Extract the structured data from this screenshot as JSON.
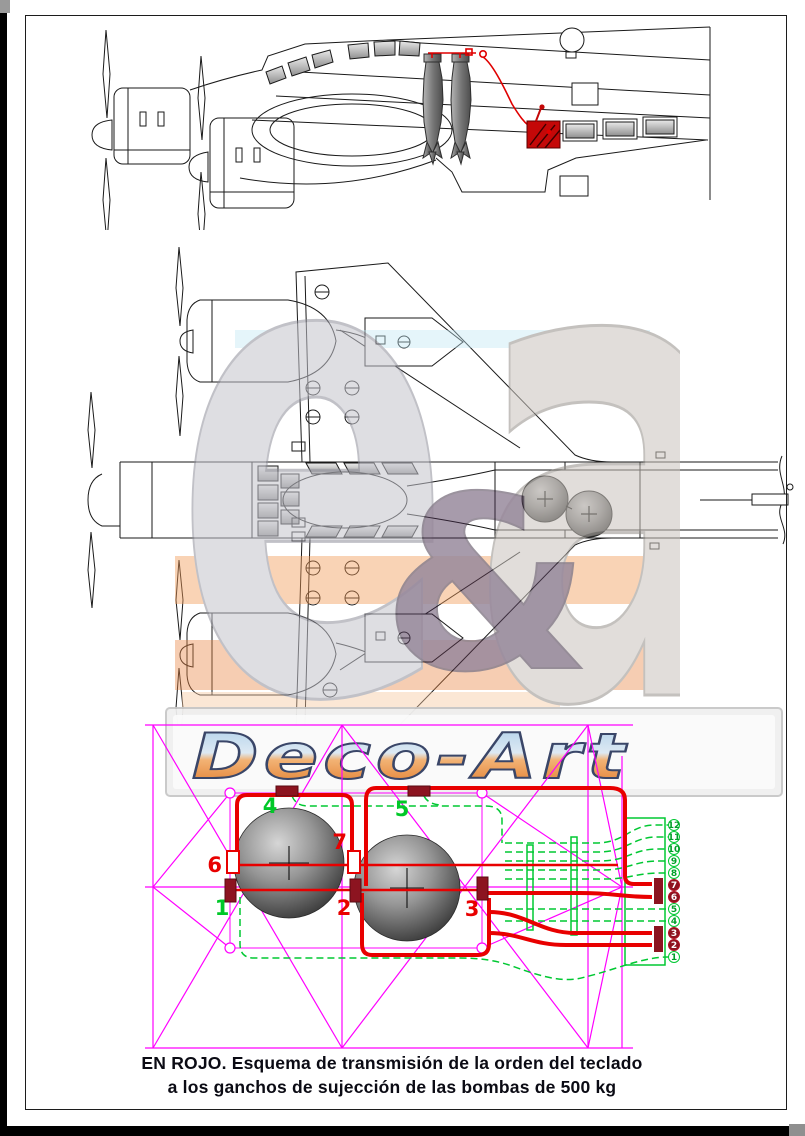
{
  "caption": {
    "line1": "EN ROJO. Esquema de transmisión de la orden del teclado",
    "line2": "a los ganchos de sujección de las bombas de 500 kg"
  },
  "watermark": {
    "logo_text": "Deco-Art",
    "monogram_left": "e",
    "monogram_amp": "&",
    "monogram_right": "a"
  },
  "schematic": {
    "hooks": [
      {
        "label": "1",
        "color": "#00c828"
      },
      {
        "label": "2",
        "color": "#e80000"
      },
      {
        "label": "3",
        "color": "#e80000"
      },
      {
        "label": "4",
        "color": "#00c828"
      },
      {
        "label": "5",
        "color": "#00c828"
      },
      {
        "label": "6",
        "color": "#e80000"
      },
      {
        "label": "7",
        "color": "#e80000"
      }
    ],
    "terminals": [
      {
        "label": "12",
        "active": false
      },
      {
        "label": "11",
        "active": false
      },
      {
        "label": "10",
        "active": false
      },
      {
        "label": "9",
        "active": false
      },
      {
        "label": "8",
        "active": false
      },
      {
        "label": "7",
        "active": true
      },
      {
        "label": "6",
        "active": true
      },
      {
        "label": "5",
        "active": false
      },
      {
        "label": "4",
        "active": false
      },
      {
        "label": "3",
        "active": true
      },
      {
        "label": "2",
        "active": true
      },
      {
        "label": "1",
        "active": false
      }
    ]
  },
  "colors": {
    "construction_magenta": "#ff00ff",
    "wire_red": "#e80000",
    "fitting_dark_red": "#8c1420",
    "idle_green": "#00c832",
    "caption_text": "#0b0b14"
  }
}
